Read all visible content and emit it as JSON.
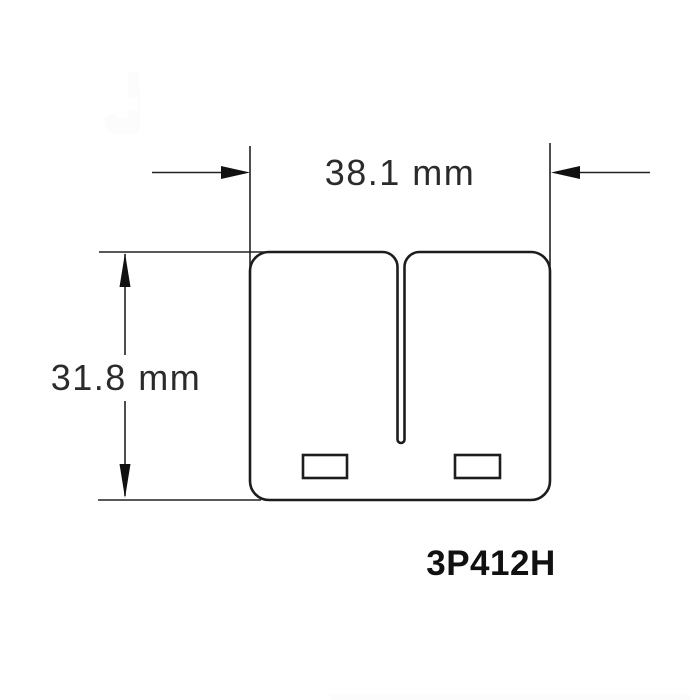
{
  "drawing": {
    "part_number": "3P412H",
    "dimensions": {
      "width": {
        "label": "38.1 mm",
        "value": 38.1,
        "unit": "mm"
      },
      "height": {
        "label": "31.8 mm",
        "value": 31.8,
        "unit": "mm"
      }
    },
    "colors": {
      "line": "#1d1d1d",
      "dimension_line": "#222222",
      "text": "#2b2b2b",
      "part_number_text": "#111111",
      "background": "#ffffff"
    }
  }
}
